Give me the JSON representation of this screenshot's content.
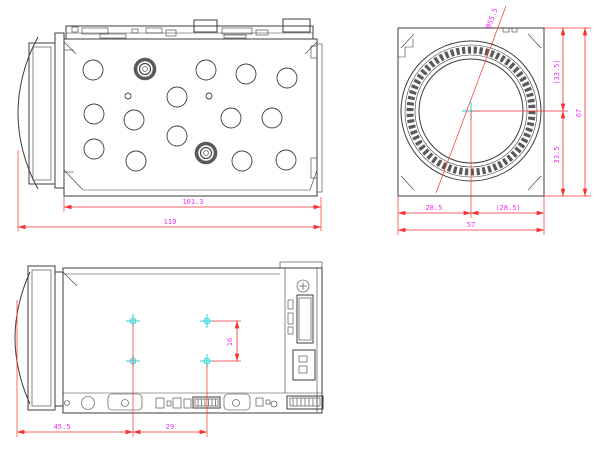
{
  "drawing": {
    "type": "cad-three-view-engineering-drawing",
    "subject": "zoom block camera module",
    "colors": {
      "outline": "#3d3d3d",
      "dimension_line": "#f93030",
      "dimension_text": "#ef2fef",
      "center_marker": "#35cfcf"
    },
    "views": {
      "top_side_view": {
        "name": "side view with perforated cover",
        "dimensions": {
          "body_length": "101.3",
          "overall_length": "119"
        }
      },
      "front_view": {
        "name": "front lens view",
        "dimensions": {
          "lens_diameter": "Ø55.5",
          "center_to_top": "(33.5)",
          "center_to_bottom": "33.5",
          "overall_height": "67",
          "center_to_left": "28.5",
          "center_to_right": "(28.5)",
          "overall_width": "57"
        }
      },
      "bottom_side_view": {
        "name": "bottom side view with mounting holes",
        "dimensions": {
          "front_to_hole_column": "45.5",
          "hole_column_spacing": "29",
          "hole_row_spacing": "16"
        }
      }
    }
  }
}
